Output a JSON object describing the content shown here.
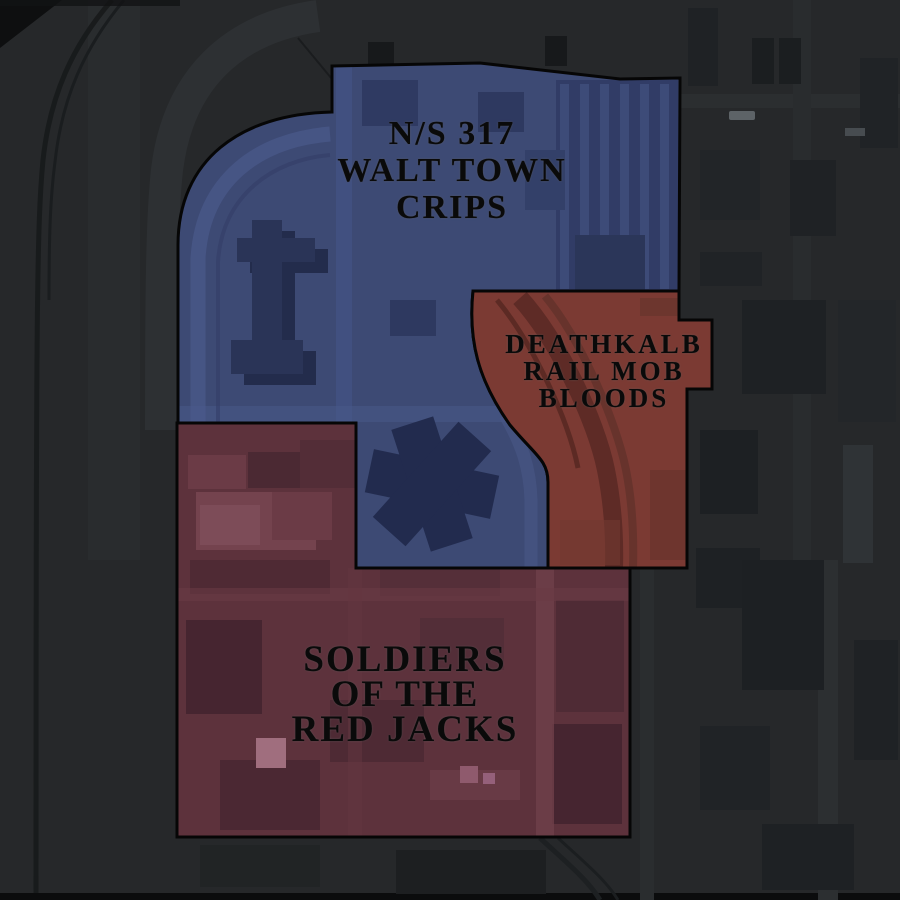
{
  "map": {
    "background_color": "#26282a",
    "territory_border_color": "#060606",
    "label_text_color": "#0a0a0a",
    "territories": [
      {
        "id": "crips",
        "name": "N/S 317 Walt Town Crips",
        "label_lines": [
          "N/S 317",
          "WALT TOWN",
          "CRIPS"
        ],
        "fill_color": "#3d4a74"
      },
      {
        "id": "bloods",
        "name": "Deathkalb Rail Mob Bloods",
        "label_lines": [
          "DEATHKALB",
          "RAIL MOB",
          "BLOODS"
        ],
        "fill_color": "#7b3a33"
      },
      {
        "id": "redjacks",
        "name": "Soldiers of the Red Jacks",
        "label_lines": [
          "SOLDIERS",
          "OF THE",
          "RED JACKS"
        ],
        "fill_color": "#5d323c"
      }
    ]
  }
}
